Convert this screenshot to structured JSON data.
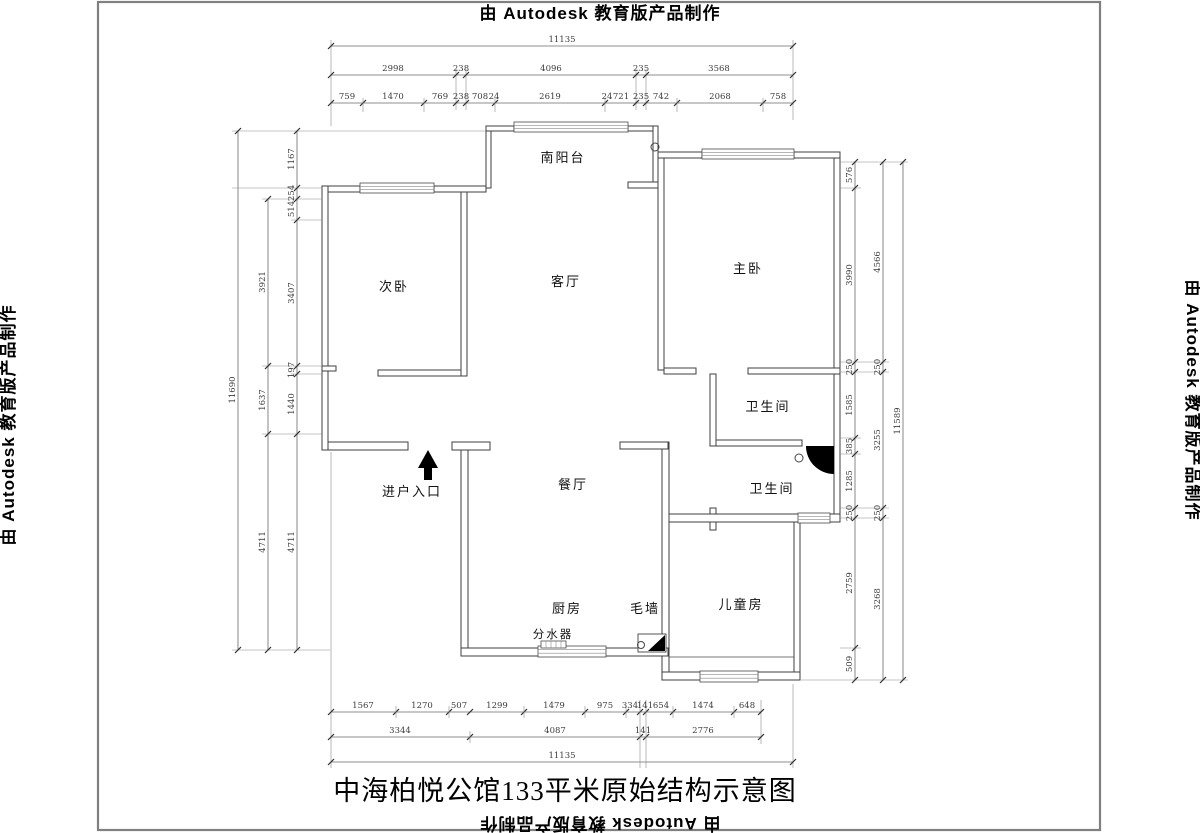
{
  "stamp": "由 Autodesk 教育版产品制作",
  "title": "中海柏悦公馆133平米原始结构示意图",
  "rooms": {
    "balcony": "南阳台",
    "second_bedroom": "次卧",
    "living_room": "客厅",
    "master_bedroom": "主卧",
    "bathroom_upper": "卫生间",
    "bathroom_lower": "卫生间",
    "dining_room": "餐厅",
    "entrance": "进户入口",
    "kitchen": "厨房",
    "rough_wall": "毛墙",
    "water_manifold": "分水器",
    "kids_room": "儿童房"
  },
  "dims": {
    "top": {
      "total": "11135",
      "row2": [
        "2998",
        "238",
        "4096",
        "235",
        "3568"
      ],
      "row3": [
        "759",
        "1470",
        "769",
        "238",
        "708",
        "24",
        "2619",
        "24",
        "721",
        "235",
        "742",
        "2068",
        "758"
      ]
    },
    "bottom": {
      "row1": [
        "1567",
        "1270",
        "507",
        "1299",
        "1479",
        "975",
        "334",
        "141",
        "654",
        "1474",
        "648"
      ],
      "row2": [
        "3344",
        "4087",
        "141",
        "2776"
      ],
      "total": "11135"
    },
    "left": {
      "inner": [
        "1167",
        "254",
        "514",
        "3407",
        "197",
        "1440",
        "4711"
      ],
      "middle": [
        "3921",
        "1637",
        "4711"
      ],
      "total": "11690"
    },
    "right": {
      "inner": [
        "576",
        "3990",
        "250",
        "1585",
        "385",
        "1285",
        "250",
        "2759",
        "509"
      ],
      "middle": [
        "4566",
        "250",
        "3255",
        "250",
        "3268"
      ],
      "total": "11589"
    }
  }
}
